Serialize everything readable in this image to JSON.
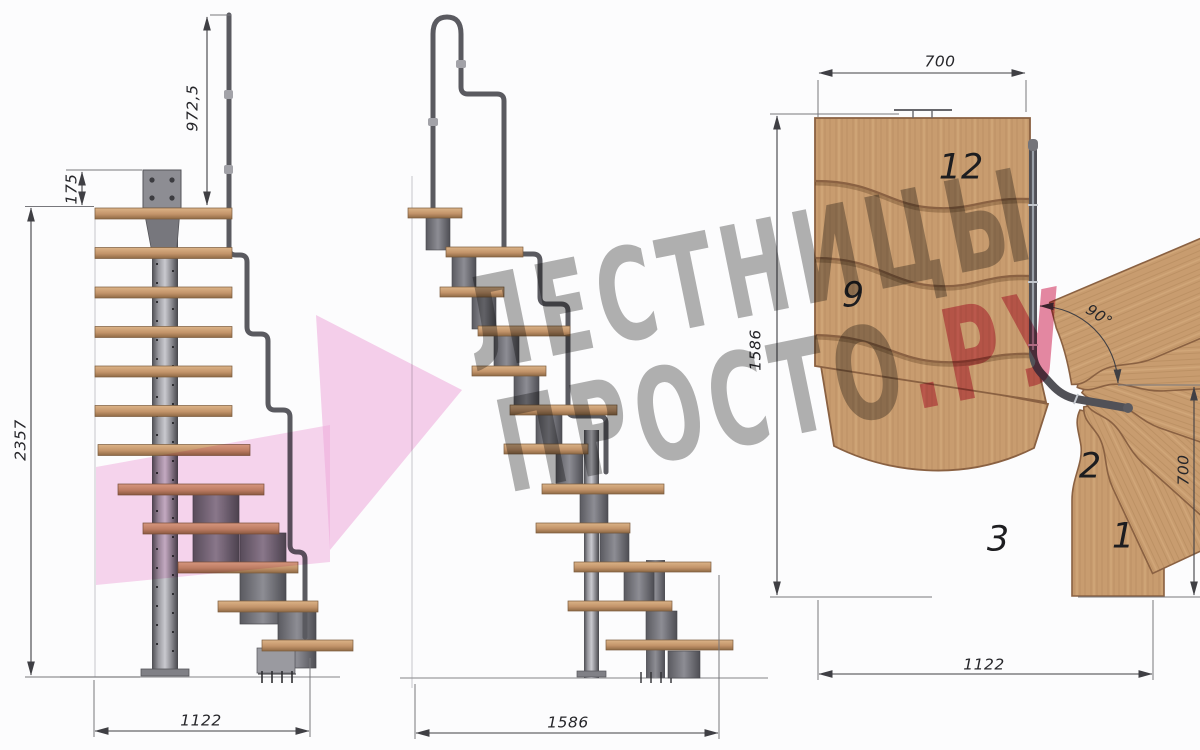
{
  "watermark": {
    "line1": "ЛЕСТНИЦЫ",
    "line2_gray": "ПРОСТО",
    "line2_pink": ".РУ"
  },
  "front_view": {
    "rail_height": "972,5",
    "plate_offset": "175",
    "total_height": "2357",
    "base_width": "1122"
  },
  "side_view": {
    "base_length": "1586"
  },
  "plan_view": {
    "top_width": "700",
    "left_depth": "1586",
    "right_depth": "700",
    "bottom_width": "1122",
    "turn_angle": "90°",
    "steps": {
      "s12": "12",
      "s9": "9",
      "s3": "3",
      "s2": "2",
      "s1": "1"
    }
  },
  "colors": {
    "wood": "#c89c6f",
    "wood_edge": "#8a6142",
    "metal": "#77777c",
    "metal_dark": "#55555a",
    "dimension_line": "#3f3f44",
    "watermark_gray": "#6a6a6a",
    "watermark_pink": "#d63a64",
    "arrow_pink": "#f2b5e0"
  }
}
